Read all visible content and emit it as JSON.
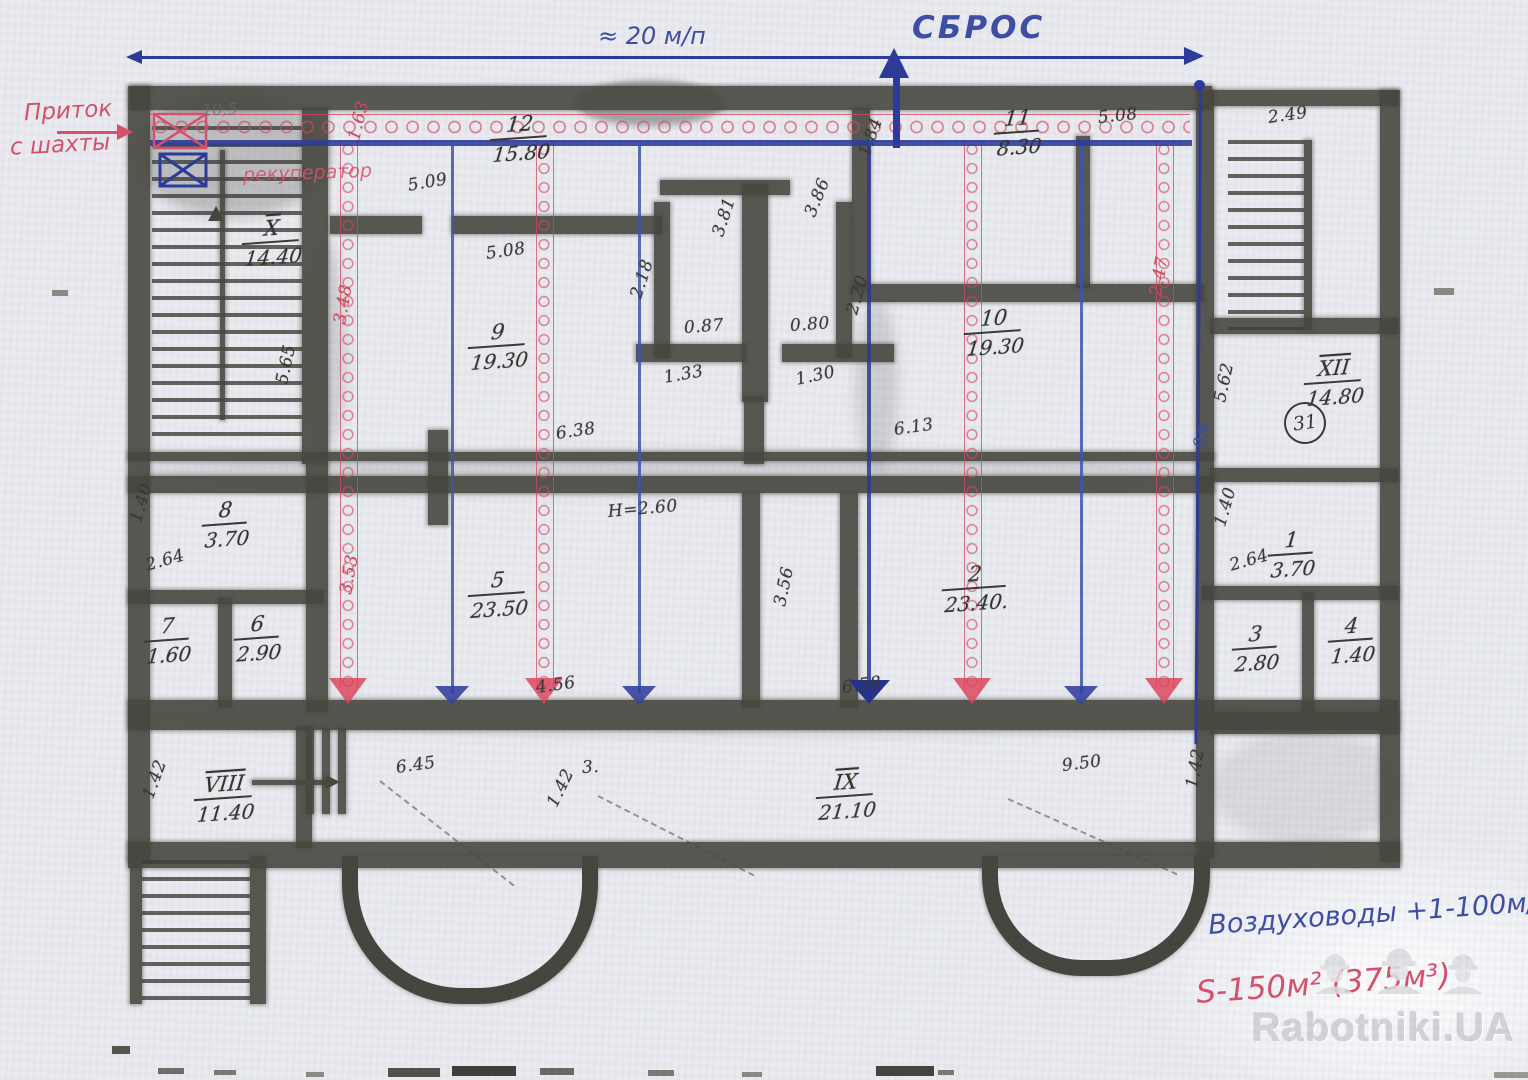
{
  "notes": {
    "top_length": "≈ 20 м/п",
    "sbros": "СБРОС",
    "pritok_1": "Приток",
    "pritok_2": "с шахты",
    "rekuperator": "рекуператор",
    "duct_note": "Воздуховоды +1-100м/п",
    "area_note": "S-150м² (375м³)",
    "line_length": "9м",
    "pencil_note": "10,5",
    "circle_label": "31"
  },
  "watermark": {
    "brand": "Rabotniki.UA"
  },
  "rooms": [
    {
      "n": "12",
      "a": "15.80",
      "x": 492,
      "y": 112
    },
    {
      "n": "9",
      "a": "19.30",
      "x": 470,
      "y": 320
    },
    {
      "n": "11",
      "a": "8.30",
      "x": 996,
      "y": 106
    },
    {
      "n": "10",
      "a": "19.30",
      "x": 966,
      "y": 306
    },
    {
      "n": "5",
      "a": "23.50",
      "x": 470,
      "y": 568
    },
    {
      "n": "2",
      "a": "23.40.",
      "x": 944,
      "y": 562
    },
    {
      "n": "8",
      "a": "3.70",
      "x": 204,
      "y": 498
    },
    {
      "n": "7",
      "a": "1.60",
      "x": 146,
      "y": 614
    },
    {
      "n": "6",
      "a": "2.90",
      "x": 236,
      "y": 612
    },
    {
      "n": "X",
      "a": "14.40",
      "rm": true,
      "x": 244,
      "y": 216
    },
    {
      "n": "XII",
      "a": "14.80",
      "rm": true,
      "x": 1306,
      "y": 356
    },
    {
      "n": "1",
      "a": "3.70",
      "x": 1270,
      "y": 528
    },
    {
      "n": "3",
      "a": "2.80",
      "x": 1234,
      "y": 622
    },
    {
      "n": "4",
      "a": "1.40",
      "x": 1330,
      "y": 614
    },
    {
      "n": "VIII",
      "a": "11.40",
      "rm": true,
      "x": 196,
      "y": 772
    },
    {
      "n": "IX",
      "a": "21.10",
      "rm": true,
      "x": 818,
      "y": 770
    }
  ],
  "dims": [
    {
      "t": "5.09",
      "x": 408,
      "y": 176,
      "r": -10
    },
    {
      "t": "5.08",
      "x": 486,
      "y": 244,
      "r": -8
    },
    {
      "t": "5.08",
      "x": 1098,
      "y": 108,
      "r": -6
    },
    {
      "t": "2.18",
      "x": 636,
      "y": 288,
      "r": -72
    },
    {
      "t": "3.81",
      "x": 718,
      "y": 226,
      "r": -72
    },
    {
      "t": "3.86",
      "x": 810,
      "y": 206,
      "r": -68
    },
    {
      "t": "0.87",
      "x": 684,
      "y": 318,
      "r": -4
    },
    {
      "t": "0.80",
      "x": 790,
      "y": 316,
      "r": -4
    },
    {
      "t": "1.33",
      "x": 664,
      "y": 368,
      "r": -10
    },
    {
      "t": "1.30",
      "x": 796,
      "y": 370,
      "r": -12
    },
    {
      "t": "6.38",
      "x": 556,
      "y": 424,
      "r": -8
    },
    {
      "t": "6.13",
      "x": 894,
      "y": 420,
      "r": -8
    },
    {
      "t": "5.65",
      "x": 282,
      "y": 374,
      "r": -78
    },
    {
      "t": "1.84",
      "x": 864,
      "y": 146,
      "r": -70
    },
    {
      "t": "2.20",
      "x": 852,
      "y": 304,
      "r": -74
    },
    {
      "t": "5.62",
      "x": 1220,
      "y": 392,
      "r": -78
    },
    {
      "t": "2.49",
      "x": 1268,
      "y": 108,
      "r": -8
    },
    {
      "t": "1.40",
      "x": 136,
      "y": 512,
      "r": -74
    },
    {
      "t": "2.64",
      "x": 146,
      "y": 556,
      "r": -16
    },
    {
      "t": "1.40",
      "x": 1220,
      "y": 516,
      "r": -74
    },
    {
      "t": "2.64",
      "x": 1230,
      "y": 556,
      "r": -16
    },
    {
      "t": "Н=2.60",
      "x": 608,
      "y": 502,
      "r": -5
    },
    {
      "t": "3.56",
      "x": 780,
      "y": 596,
      "r": -78
    },
    {
      "t": "4.56",
      "x": 536,
      "y": 678,
      "r": -8
    },
    {
      "t": "6.58",
      "x": 842,
      "y": 678,
      "r": -8
    },
    {
      "t": "9.50",
      "x": 1062,
      "y": 756,
      "r": -7
    },
    {
      "t": "6.45",
      "x": 396,
      "y": 758,
      "r": -8
    },
    {
      "t": "3.",
      "x": 582,
      "y": 758,
      "r": -4
    },
    {
      "t": "1.42",
      "x": 552,
      "y": 796,
      "r": -64
    },
    {
      "t": "1.42",
      "x": 148,
      "y": 788,
      "r": -70
    },
    {
      "t": "1.42",
      "x": 1192,
      "y": 778,
      "r": -80
    },
    {
      "t": "1.63",
      "x": 354,
      "y": 130,
      "r": -76,
      "c": "red"
    },
    {
      "t": "3.48",
      "x": 340,
      "y": 314,
      "r": -80,
      "c": "red"
    },
    {
      "t": "3.53",
      "x": 346,
      "y": 584,
      "r": -80,
      "c": "red"
    },
    {
      "t": "2.47",
      "x": 1156,
      "y": 286,
      "r": -80,
      "c": "red"
    },
    {
      "t": "9м",
      "x": 1200,
      "y": 438,
      "r": -82,
      "c": "blue"
    }
  ]
}
